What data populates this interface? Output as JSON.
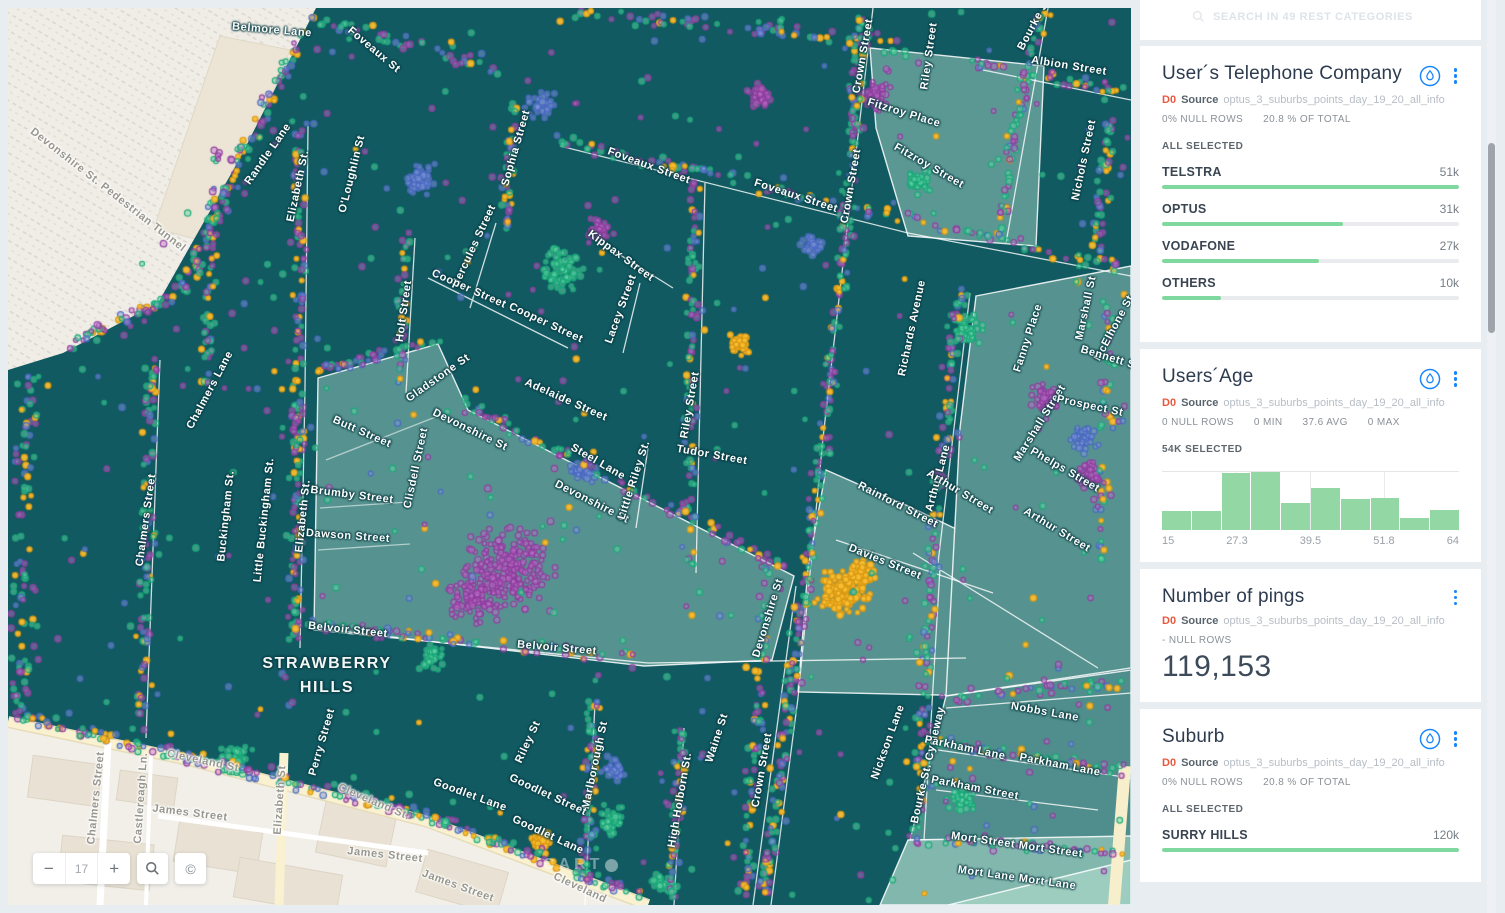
{
  "app": {
    "watermark": "CARTO"
  },
  "map": {
    "zoom_control": {
      "minus": "−",
      "level": "17",
      "plus": "+"
    },
    "attribution_symbol": "©",
    "area_label": {
      "line1": "STRAWBERRY",
      "line2": "HILLS",
      "x": 319,
      "y": 668
    },
    "street_labels": [
      [
        "Belmore Lane",
        264,
        22,
        5
      ],
      [
        "Foveaux St",
        366,
        42,
        40
      ],
      [
        "Randle Lane",
        260,
        146,
        -55
      ],
      [
        "Elizabeth St.",
        290,
        178,
        -78
      ],
      [
        "O'Loughlin St",
        344,
        166,
        -76
      ],
      [
        "Sophia Street",
        508,
        140,
        -74
      ],
      [
        "Foveaux Street",
        641,
        158,
        20
      ],
      [
        "Foveaux Street",
        788,
        188,
        18
      ],
      [
        "Crown Street",
        855,
        48,
        -80
      ],
      [
        "Crown Street",
        843,
        178,
        -80
      ],
      [
        "Riley Street",
        921,
        48,
        -82
      ],
      [
        "Bourke St",
        1026,
        16,
        -62
      ],
      [
        "Albion Street",
        1061,
        58,
        9
      ],
      [
        "Fitzroy Place",
        896,
        105,
        17
      ],
      [
        "Fitzroy Street",
        921,
        158,
        30
      ],
      [
        "Nichols Street",
        1076,
        152,
        -78
      ],
      [
        "Hercules Street",
        466,
        238,
        -65
      ],
      [
        "Cooper Street",
        461,
        281,
        24
      ],
      [
        "Cooper Street",
        538,
        315,
        25
      ],
      [
        "Kippax Street",
        613,
        248,
        36
      ],
      [
        "Lacey Street",
        613,
        301,
        -70
      ],
      [
        "Riley Street",
        682,
        397,
        -80
      ],
      [
        "Holt Street",
        396,
        303,
        -82
      ],
      [
        "Gladstone St",
        430,
        370,
        -35
      ],
      [
        "Chalmers Lane",
        202,
        382,
        -62
      ],
      [
        "Chalmers Street",
        138,
        512,
        -82
      ],
      [
        "Buckingham St.",
        218,
        508,
        -84
      ],
      [
        "Little Buckingham St.",
        256,
        512,
        -84
      ],
      [
        "Elizabeth St.",
        295,
        508,
        -84
      ],
      [
        "Clisdell Street",
        408,
        460,
        -78
      ],
      [
        "Butt Street",
        354,
        424,
        24
      ],
      [
        "Brumby Street",
        344,
        487,
        7
      ],
      [
        "Dawson Street",
        340,
        528,
        4
      ],
      [
        "Adelaide Street",
        558,
        392,
        24
      ],
      [
        "Devonshire St",
        462,
        422,
        26
      ],
      [
        "Devonshire St",
        584,
        494,
        27
      ],
      [
        "Steel Lane",
        590,
        454,
        30
      ],
      [
        "Little Riley St.",
        626,
        472,
        -72
      ],
      [
        "Tudor Street",
        704,
        447,
        10
      ],
      [
        "Richards Avenue",
        904,
        320,
        -78
      ],
      [
        "Fanny Place",
        1020,
        330,
        -72
      ],
      [
        "Marshall St",
        1078,
        300,
        -78
      ],
      [
        "McElhone St",
        1106,
        320,
        -62
      ],
      [
        "Bennett St",
        1102,
        350,
        17
      ],
      [
        "Marshall Street",
        1032,
        415,
        -58
      ],
      [
        "Prospect St",
        1082,
        398,
        12
      ],
      [
        "Phelps Street",
        1057,
        462,
        30
      ],
      [
        "Arthur Lane",
        930,
        470,
        -75
      ],
      [
        "Arthur Street",
        952,
        484,
        31
      ],
      [
        "Arthur Street",
        1049,
        522,
        31
      ],
      [
        "Rainford Street",
        890,
        497,
        27
      ],
      [
        "Davies Street",
        877,
        554,
        22
      ],
      [
        "Devonshire St",
        760,
        610,
        -73
      ],
      [
        "Belvoir Street",
        340,
        622,
        6
      ],
      [
        "Belvoir Street",
        549,
        640,
        5
      ],
      [
        "High Holborn St.",
        672,
        792,
        -80
      ],
      [
        "Marlborough St",
        587,
        757,
        -78
      ],
      [
        "Riley St",
        520,
        734,
        -65
      ],
      [
        "Goodlet Lane",
        462,
        787,
        20
      ],
      [
        "Goodlet Street",
        540,
        787,
        25
      ],
      [
        "Goodlet Lane",
        540,
        827,
        25
      ],
      [
        "Waine St",
        709,
        730,
        -72
      ],
      [
        "Crown Street",
        754,
        762,
        -80
      ],
      [
        "Perry Street",
        314,
        734,
        -74
      ],
      [
        "Nickson Lane",
        880,
        734,
        -70
      ],
      [
        "Bourke St. Cycleway",
        920,
        757,
        -77
      ],
      [
        "Nobbs Lane",
        1037,
        704,
        10
      ],
      [
        "Parkham Lane",
        957,
        740,
        12
      ],
      [
        "Parkham Lane",
        1052,
        757,
        11
      ],
      [
        "Parkham Street",
        967,
        780,
        11
      ],
      [
        "Mort Street Mort Street",
        1009,
        837,
        8
      ],
      [
        "Mort Lane Mort Lane",
        1009,
        870,
        8
      ]
    ],
    "base_labels": [
      [
        "Devonshire St. Pedestrian Tunnel",
        100,
        182,
        38
      ],
      [
        "Chalmers Street",
        88,
        790,
        -84
      ],
      [
        "Castlereagh Ln.",
        133,
        790,
        -86
      ],
      [
        "James Street",
        182,
        805,
        7
      ],
      [
        "Elizabeth St",
        272,
        792,
        -86
      ],
      [
        "Cleveland St",
        195,
        753,
        12
      ],
      [
        "Cleveland St.",
        366,
        794,
        23
      ],
      [
        "James Street",
        377,
        847,
        6
      ],
      [
        "James Street",
        450,
        878,
        20
      ],
      [
        "Cleveland",
        572,
        880,
        25
      ]
    ]
  },
  "sidebar": {
    "search_hint": "SEARCH IN 49 REST CATEGORIES",
    "widgets": [
      {
        "title": "User´s Telephone Company",
        "source_tag": "D0",
        "source_word": "Source",
        "source_name": "optus_3_suburbs_points_day_19_20_all_info",
        "stats": [
          "0% NULL ROWS",
          "20.8 % OF TOTAL"
        ],
        "selection": "ALL SELECTED",
        "has_droplet": true,
        "categories": [
          {
            "name": "TELSTRA",
            "value": "51k",
            "pct": 100
          },
          {
            "name": "OPTUS",
            "value": "31k",
            "pct": 61
          },
          {
            "name": "VODAFONE",
            "value": "27k",
            "pct": 53
          },
          {
            "name": "OTHERS",
            "value": "10k",
            "pct": 20
          }
        ]
      },
      {
        "title": "Users´Age",
        "source_tag": "D0",
        "source_word": "Source",
        "source_name": "optus_3_suburbs_points_day_19_20_all_info",
        "stats": [
          "0 NULL ROWS",
          "0 MIN",
          "37.6 AVG",
          "0 MAX"
        ],
        "selection": "54K SELECTED",
        "has_droplet": true,
        "histogram": {
          "bins": [
            0.33,
            0.33,
            0.98,
            1.0,
            0.47,
            0.73,
            0.54,
            0.55,
            0.2,
            0.34
          ],
          "ticks": [
            "15",
            "27.3",
            "39.5",
            "51.8",
            "64"
          ],
          "min": 15,
          "max": 64
        }
      },
      {
        "title": "Number of pings",
        "source_tag": "D0",
        "source_word": "Source",
        "source_name": "optus_3_suburbs_points_day_19_20_all_info",
        "stats": [
          "- NULL ROWS"
        ],
        "has_droplet": false,
        "big_number": "119,153"
      },
      {
        "title": "Suburb",
        "source_tag": "D0",
        "source_word": "Source",
        "source_name": "optus_3_suburbs_points_day_19_20_all_info",
        "stats": [
          "0% NULL ROWS",
          "20.8 % OF TOTAL"
        ],
        "selection": "ALL SELECTED",
        "has_droplet": true,
        "categories": [
          {
            "name": "SURRY HILLS",
            "value": "120k",
            "pct": 100
          }
        ]
      }
    ]
  },
  "chart_data": [
    {
      "type": "bar",
      "title": "User´s Telephone Company",
      "categories": [
        "TELSTRA",
        "OPTUS",
        "VODAFONE",
        "OTHERS"
      ],
      "values": [
        51000,
        31000,
        27000,
        10000
      ]
    },
    {
      "type": "bar",
      "title": "Users´Age histogram",
      "xlabel": "age",
      "x_range": [
        15,
        64
      ],
      "tick_labels": [
        "15",
        "27.3",
        "39.5",
        "51.8",
        "64"
      ],
      "values_relative": [
        0.33,
        0.33,
        0.98,
        1.0,
        0.47,
        0.73,
        0.54,
        0.55,
        0.2,
        0.34
      ]
    },
    {
      "type": "bar",
      "title": "Suburb",
      "categories": [
        "SURRY HILLS"
      ],
      "values": [
        120000
      ]
    }
  ],
  "colors": {
    "accent_blue": "#1785fb",
    "bar_green": "#7fd89d",
    "dark_teal": "#115a62",
    "light_teal": "#569390",
    "dot_purple": "#8e3d9e",
    "dot_green": "#18a878",
    "dot_blue": "#4a68c0",
    "dot_yellow": "#f0b42a",
    "source_orange": "#e8583c"
  }
}
